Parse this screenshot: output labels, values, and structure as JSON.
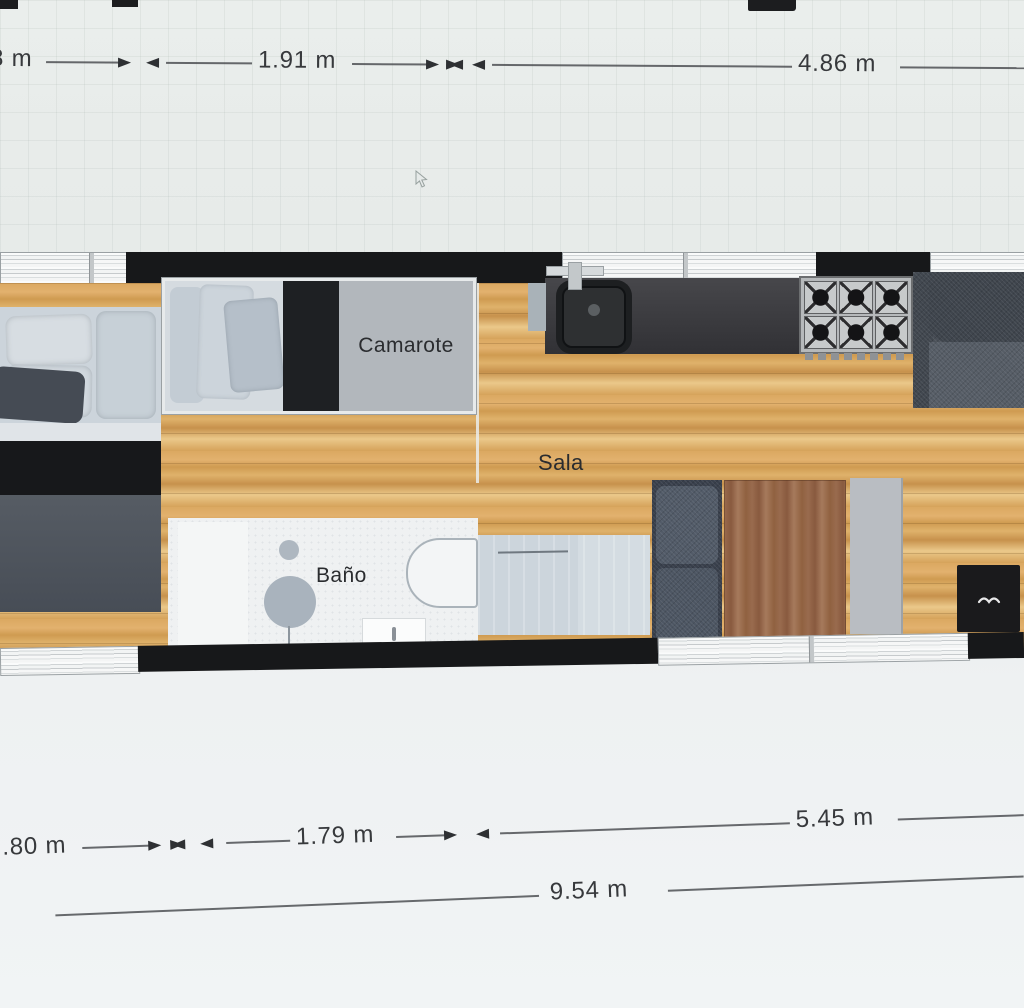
{
  "floorplan": {
    "rooms": [
      {
        "id": "camarote",
        "label": "Camarote"
      },
      {
        "id": "sala",
        "label": "Sala"
      },
      {
        "id": "bano",
        "label": "Baño"
      }
    ],
    "dimensions": {
      "top": [
        "8 m",
        "1.91 m",
        "4.86 m"
      ],
      "middle": [
        ".80 m",
        "1.79 m",
        "5.45 m"
      ],
      "overall": "9.54 m"
    },
    "unit": "m",
    "furniture": [
      "double-bed",
      "bunk-bed",
      "bathroom-sink",
      "bathtub",
      "toilet",
      "shower",
      "kitchen-sink",
      "gas-stove",
      "sofa",
      "loveseat",
      "dining-table",
      "cabinet",
      "fireplace-stove"
    ],
    "colors": {
      "background": "#e8ecea",
      "wall_black": "#17181a",
      "window_frame": "#f2f4f4",
      "wood_floor": "#d8a55c",
      "kitchen_counter": "#3a3a3d",
      "upholstery": "#4e555e",
      "dimension_text": "#37393c"
    }
  }
}
